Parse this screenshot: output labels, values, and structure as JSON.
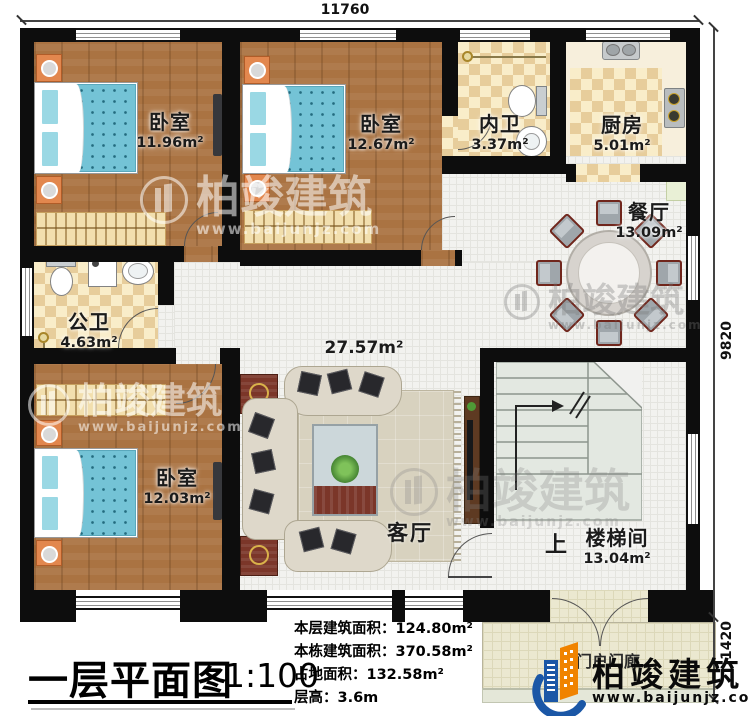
{
  "dimensions": {
    "top": "11760",
    "right_main": "9820",
    "right_porch": "1420"
  },
  "rooms": {
    "bedroom_tl": {
      "name": "卧室",
      "area": "11.96m²"
    },
    "bedroom_tm": {
      "name": "卧室",
      "area": "12.67m²"
    },
    "bath_inner": {
      "name": "内卫",
      "area": "3.37m²"
    },
    "kitchen": {
      "name": "厨房",
      "area": "5.01m²"
    },
    "dining": {
      "name": "餐厅",
      "area": "13.09m²"
    },
    "bath_public": {
      "name": "公卫",
      "area": "4.63m²"
    },
    "bedroom_bl": {
      "name": "卧室",
      "area": "12.03m²"
    },
    "living": {
      "name": "客厅",
      "area": "27.57m²"
    },
    "stairwell": {
      "name": "楼梯间",
      "area": "13.04m²",
      "up_label": "上"
    },
    "porch": {
      "name": "入门户门廊"
    }
  },
  "title_block": {
    "title": "一层平面图",
    "scale": "1:100",
    "stats": [
      "本层建筑面积：124.80m²",
      "本栋建筑面积：370.58m²",
      "占地面积：132.58m²",
      "层高：3.6m"
    ]
  },
  "brand": {
    "name": "柏竣建筑",
    "website": "www.baijunjz.com"
  },
  "watermark": {
    "text": "柏竣建筑",
    "website": "www.baijunjz.com"
  }
}
